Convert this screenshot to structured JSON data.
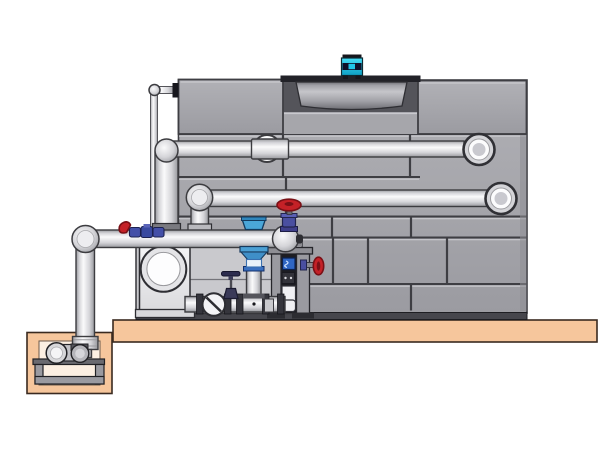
{
  "scene": {
    "type": "technical-illustration",
    "subject": "Closed-circuit cooling tower with external pump skid and sump pit",
    "text_content": "none"
  },
  "components": [
    "cooling-tower-casing",
    "fan-motor",
    "fan-shroud",
    "fan-deck",
    "upper-distribution-pipe",
    "lower-distribution-pipe",
    "main-suction-pipe",
    "makeup-water-line",
    "circulation-pump",
    "pump-suction-manifold",
    "check-valve",
    "drain-valve",
    "butterfly-valve",
    "gate-valve",
    "side-gate-valve",
    "support-frame",
    "skid-back-panel",
    "concrete-slab",
    "sump-pit",
    "sump-pump",
    "sump-pump-stand"
  ],
  "colors": {
    "background": "#ffffff",
    "outline": "#3c3c40",
    "panel": "#a6a6ab",
    "panel_light": "#c9c9ce",
    "panel_dark": "#8e8e94",
    "panel_line": "#3e3e43",
    "panel_grad_top": "#b1b1b6",
    "panel_grad_bottom": "#9b9ba1",
    "recess": "#54545a",
    "deck": "#222228",
    "drum_light": "#c6c6ca",
    "drum_dark": "#6e6e74",
    "motor_cyan": "#1fc4e8",
    "motor_cyan_light": "#45dcf6",
    "motor_cyan_deep": "#0d9fc4",
    "motor_dark": "#10102a",
    "pipe_light": "#fafafb",
    "pipe_mid": "#d5d5d9",
    "pipe_shadow": "#97989d",
    "slab": "#f6c69c",
    "slab_edge": "#3a2a20",
    "pit_inner": "#fcefe2",
    "skid_panel": "#c9c9cd",
    "frame_gray": "#9a9aa0",
    "frame_dark": "#1d1d22",
    "base_strip": "#46464c",
    "valve_red": "#c42127",
    "valve_red_dark": "#7a1016",
    "valve_blue": "#4aa6d8",
    "fitting_blue": "#4450a8",
    "box_blue": "#2f66c4",
    "pump_light": "#f4f4f6",
    "pump_shadow": "#d9d9dc"
  }
}
